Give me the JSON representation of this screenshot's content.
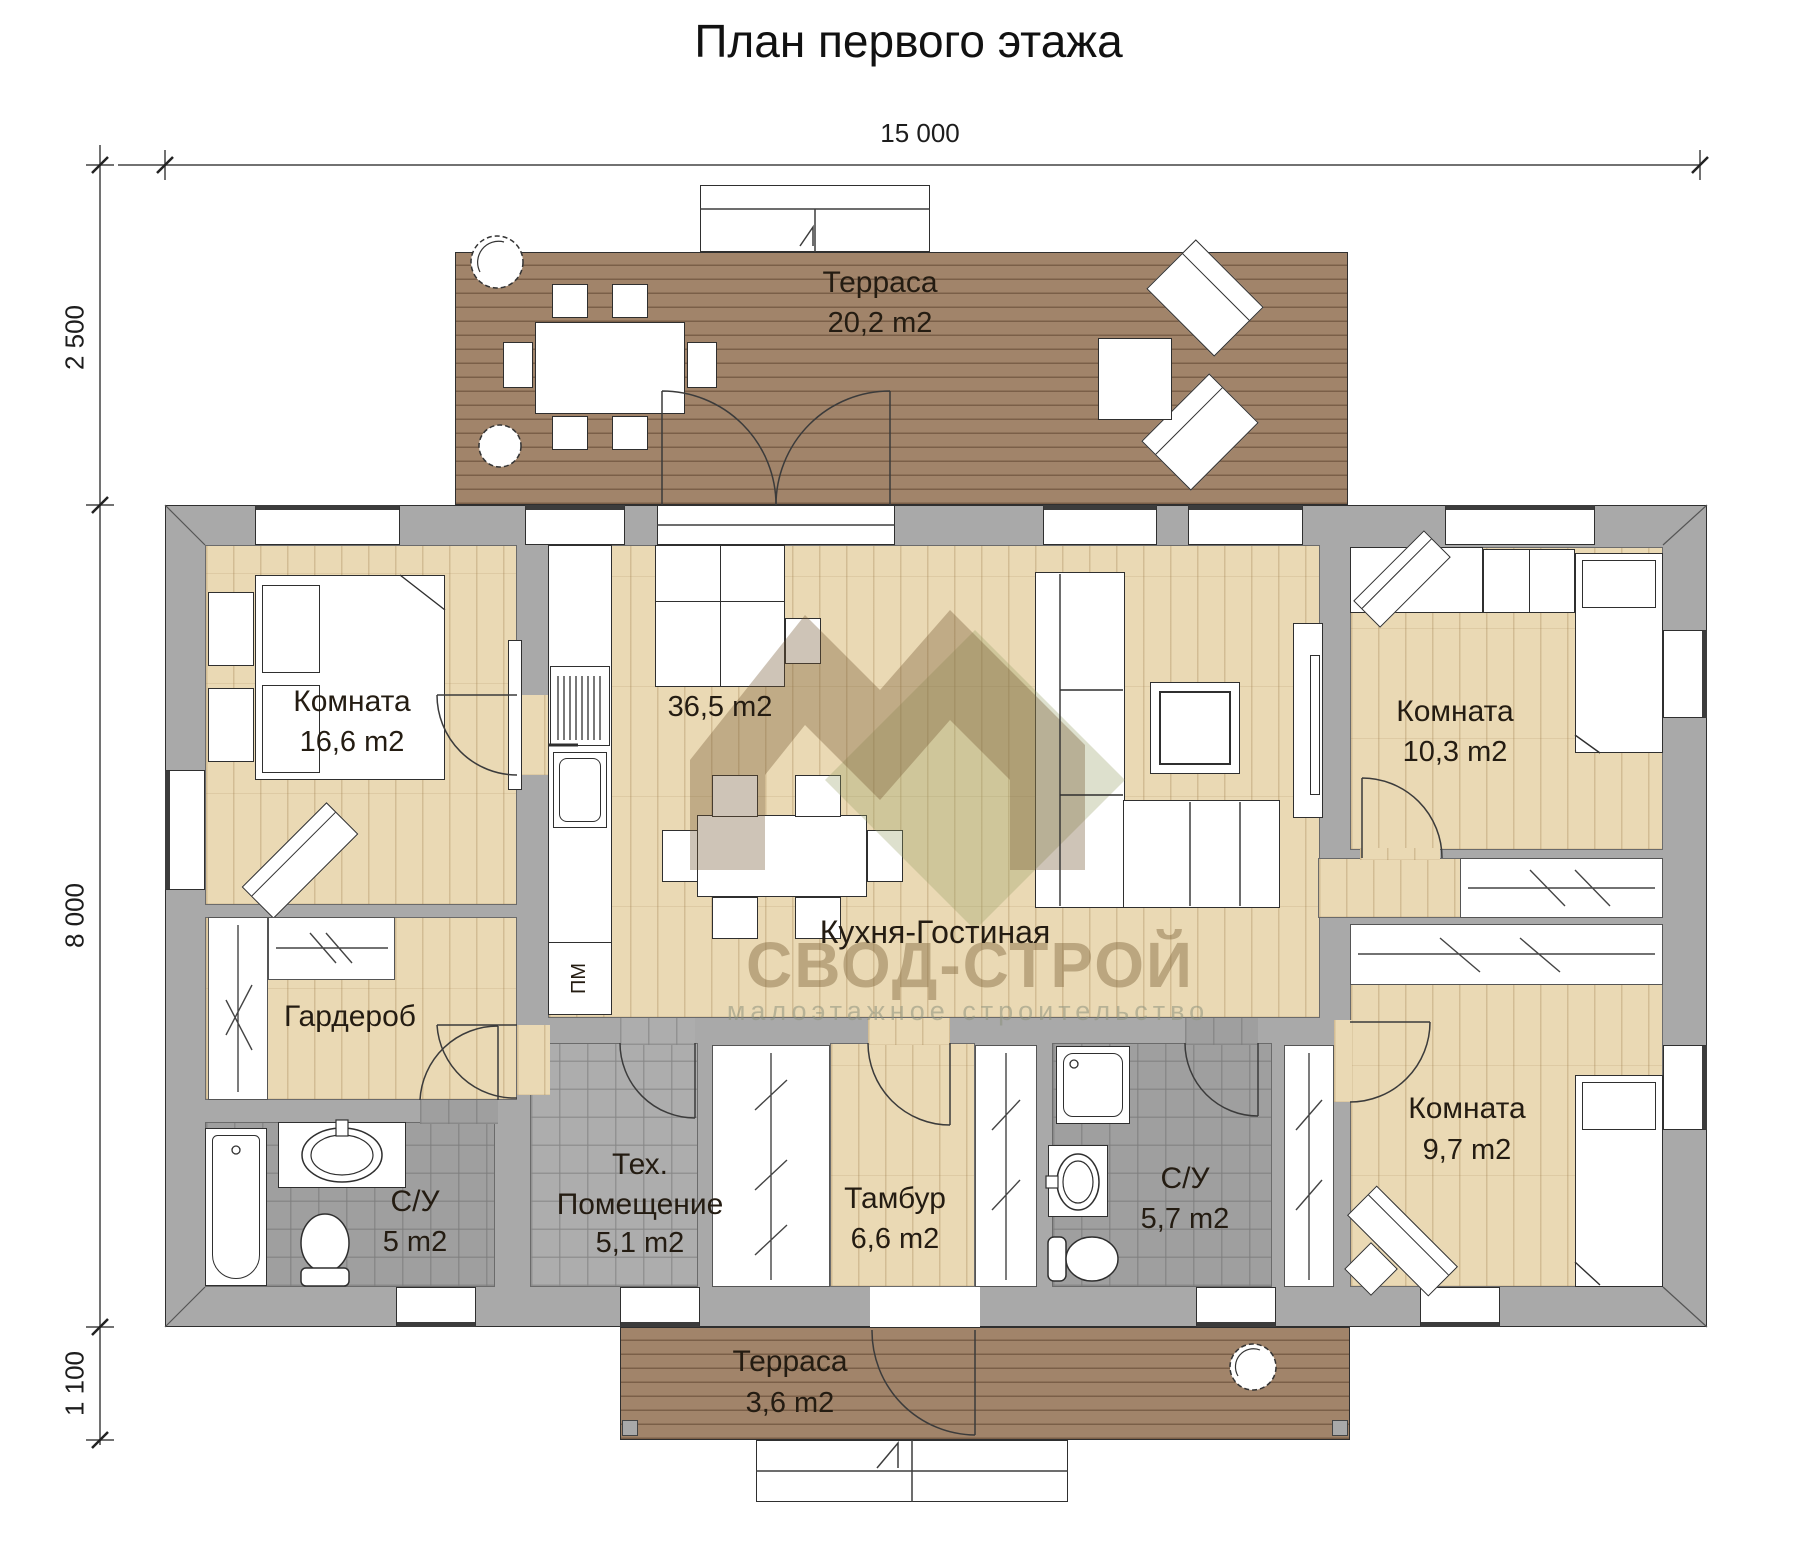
{
  "title": "План первого этажа",
  "dimensions": {
    "total_width": "15 000",
    "terrace_depth": "2 500",
    "house_depth": "8 000",
    "porch_depth": "1 100"
  },
  "rooms": {
    "terrace_top": {
      "name": "Терраса",
      "area": "20,2 m2"
    },
    "bedroom_left": {
      "name": "Комната",
      "area": "16,6 m2"
    },
    "kitchen_living": {
      "name": "Кухня-Гостиная",
      "area": "36,5 m2"
    },
    "wardrobe": {
      "name": "Гардероб"
    },
    "bathroom_left": {
      "name": "С/У",
      "area": "5 m2"
    },
    "tech_room": {
      "name_line1": "Тех.",
      "name_line2": "Помещение",
      "area": "5,1 m2"
    },
    "vestibule": {
      "name": "Тамбур",
      "area": "6,6 m2"
    },
    "bathroom_right": {
      "name": "С/У",
      "area": "5,7 m2"
    },
    "bedroom_top_right": {
      "name": "Комната",
      "area": "10,3 m2"
    },
    "bedroom_bottom_right": {
      "name": "Комната",
      "area": "9,7 m2"
    },
    "terrace_bottom": {
      "name": "Терраса",
      "area": "3,6 m2"
    }
  },
  "appliances": {
    "dishwasher_label": "ПМ"
  },
  "watermark": {
    "brand": "СВОД-СТРОЙ",
    "tagline": "малоэтажное строительство"
  },
  "colors": {
    "wall": "#a9a9a9",
    "wood_floor": "#ead9b4",
    "deck": "#a1846a",
    "tile": "#9f9f9f",
    "outline": "#333333",
    "label_text": "#241c12"
  }
}
